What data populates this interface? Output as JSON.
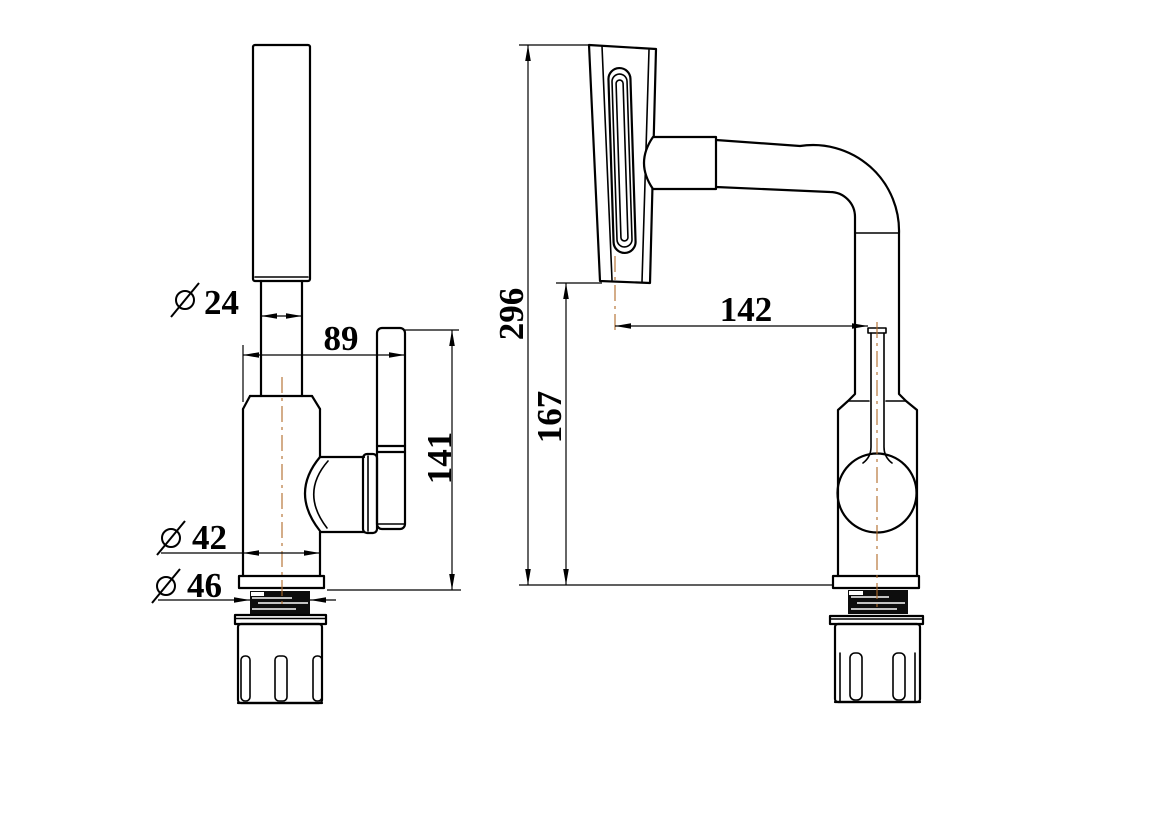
{
  "colors": {
    "outline": "#000000",
    "centerline": "#b06a28",
    "paper": "#ffffff",
    "thread_fill": "#0d0d0d"
  },
  "symbols": {
    "diameter": "⌀"
  },
  "dimensions": {
    "handle_neck_diameter": {
      "symbol": "⌀",
      "value": "24"
    },
    "spout_offset": {
      "symbol": "",
      "value": "89"
    },
    "spout_panel_height": {
      "symbol": "",
      "value": "141"
    },
    "body_diameter": {
      "symbol": "⌀",
      "value": "42"
    },
    "thread_diameter": {
      "symbol": "⌀",
      "value": "46"
    },
    "overall_height": {
      "symbol": "",
      "value": "296"
    },
    "deck_to_panel_bottom": {
      "symbol": "",
      "value": "167"
    },
    "spout_reach": {
      "symbol": "",
      "value": "142"
    }
  }
}
